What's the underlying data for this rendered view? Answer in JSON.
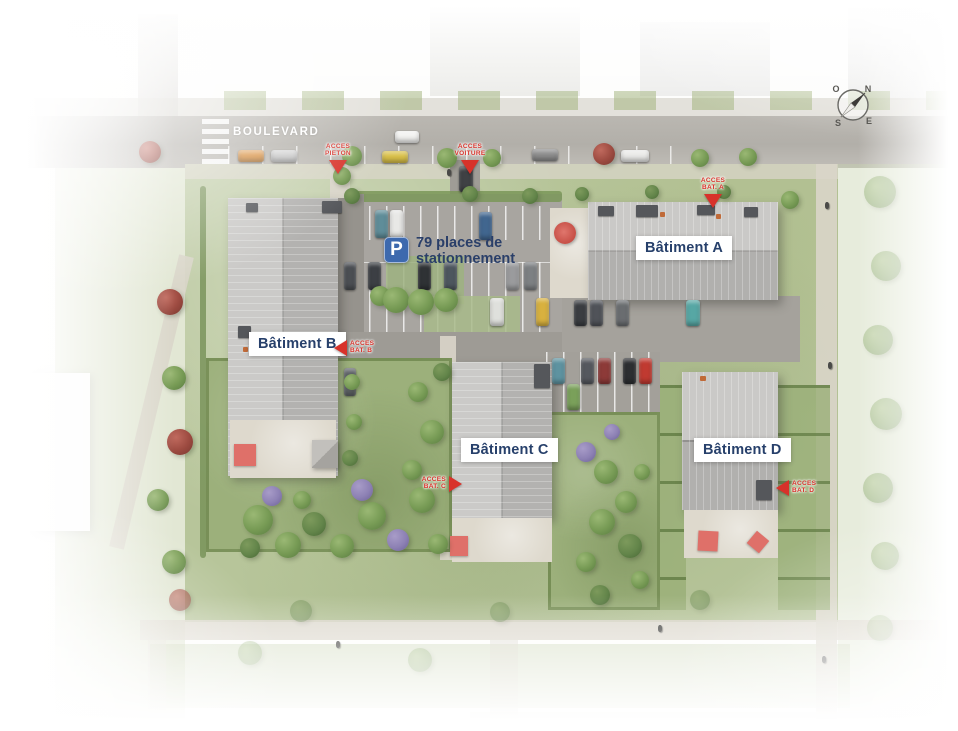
{
  "site_plan": {
    "street": {
      "name": "BOULEVARD"
    },
    "parking": {
      "icon": "parking-icon",
      "label_line1": "79 places de",
      "label_line2": "stationnement"
    },
    "buildings": [
      {
        "id": "A",
        "label": "Bâtiment A"
      },
      {
        "id": "B",
        "label": "Bâtiment B"
      },
      {
        "id": "C",
        "label": "Bâtiment C"
      },
      {
        "id": "D",
        "label": "Bâtiment D"
      }
    ],
    "access_points": [
      {
        "id": "pieton",
        "line1": "ACCES",
        "line2": "PIETON",
        "direction": "down"
      },
      {
        "id": "voiture",
        "line1": "ACCES",
        "line2": "VOITURE",
        "direction": "down"
      },
      {
        "id": "bat-a",
        "line1": "ACCES",
        "line2": "BAT. A",
        "direction": "down"
      },
      {
        "id": "bat-b",
        "line1": "ACCES",
        "line2": "BAT. B",
        "direction": "left"
      },
      {
        "id": "bat-c",
        "line1": "ACCES",
        "line2": "BAT. C",
        "direction": "right"
      },
      {
        "id": "bat-d",
        "line1": "ACCES",
        "line2": "BAT. D",
        "direction": "left"
      }
    ],
    "compass": {
      "north": "N",
      "east": "E",
      "south": "S",
      "west": "O"
    },
    "colors": {
      "accent_red": "#d8322a",
      "label_navy": "#27406b",
      "parking_blue": "#3d69ae",
      "label_bg": "#ffffff"
    }
  }
}
